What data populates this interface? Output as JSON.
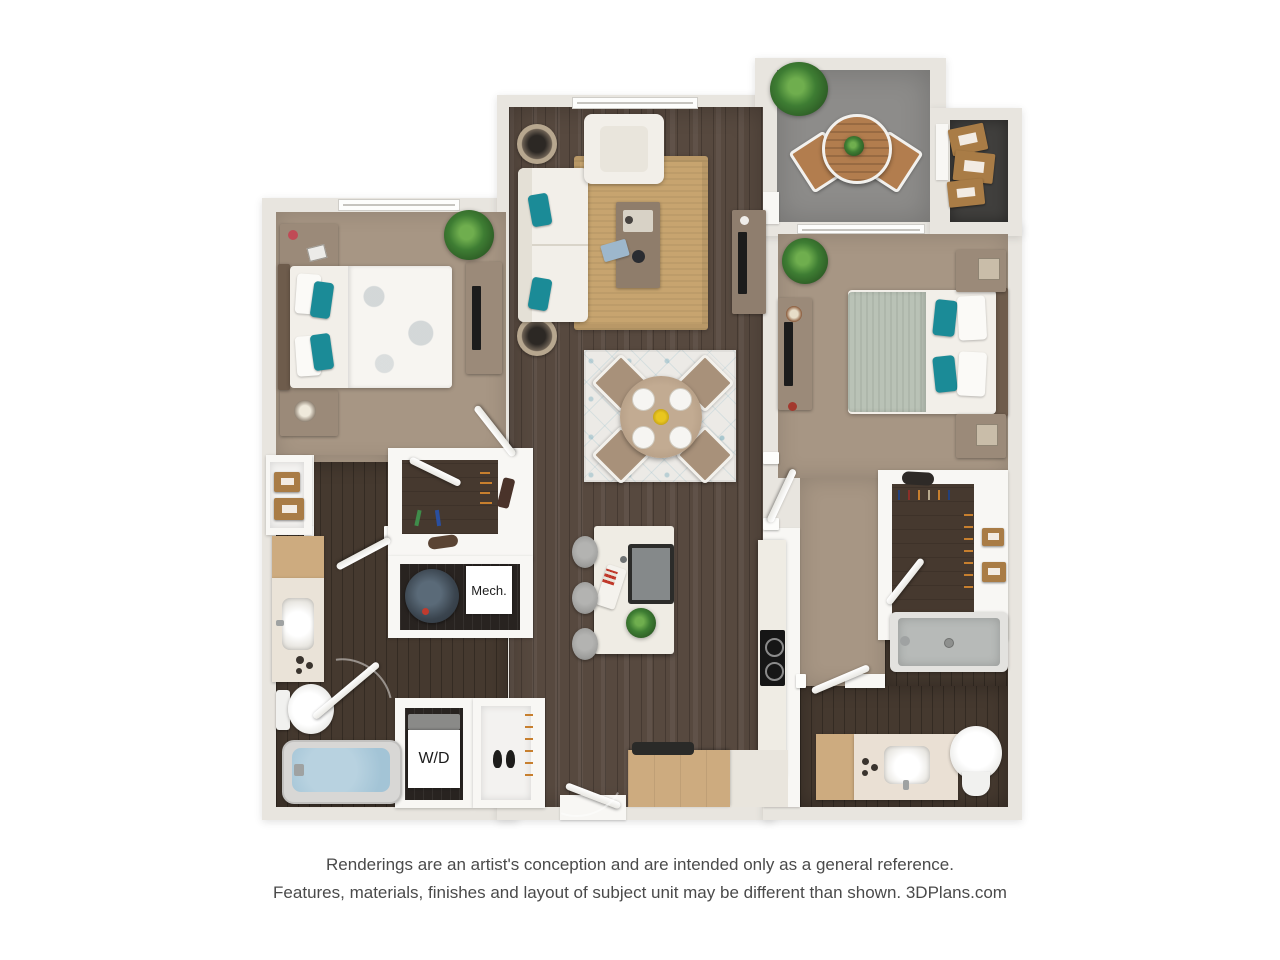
{
  "plan_labels": {
    "mech": "Mech.",
    "wd": "W/D"
  },
  "footer": {
    "line1": "Renderings are an artist's conception and are intended only as a general reference.",
    "line2": "Features, materials, finishes and layout of subject unit may be different than shown. 3DPlans.com"
  },
  "theme": {
    "wall": "#e8e5df",
    "interior_wall": "#f8f7f4",
    "wood_floor": "#57493f",
    "wood_floor_dark": "#45392f",
    "utility_floor": "#282320",
    "closet_floor": "#46392f",
    "carpet": "#a79684",
    "balcony_floor": "#8d8c8a",
    "storage_floor": "#403f3d",
    "rug_jute": "#c7a46f",
    "rug_dining": "#eceae6",
    "teal": "#1b8b97",
    "sofa": "#f2efe9",
    "wood_furniture": "#9b8a79",
    "wood_warm": "#b27d4e",
    "counter": "#efece4",
    "counter_wood": "#cdab7f",
    "water": "#a3c4d6",
    "shower": "#b7bab8",
    "sage": "#b9c2b6",
    "tv": "#1c1c1c",
    "plant": "#3e7d33",
    "box_tan": "#a97c46"
  }
}
